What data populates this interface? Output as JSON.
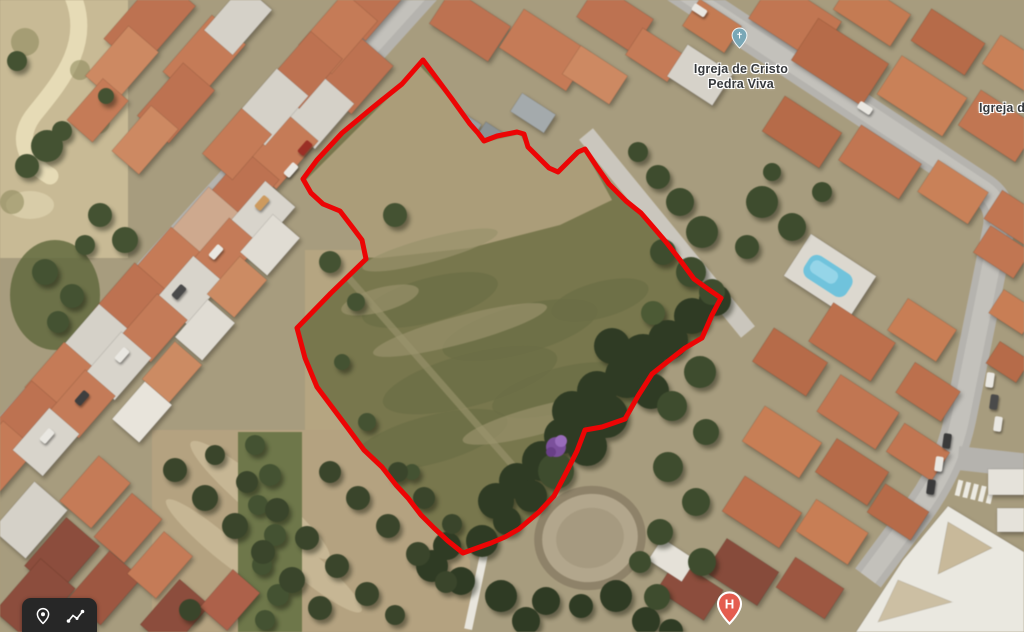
{
  "map": {
    "poi_labels": {
      "church": {
        "line1": "Igreja de Cristo",
        "line2": "Pedra Viva"
      },
      "church_partial": "Igreja d"
    },
    "markers": {
      "church": {
        "glyph": "✝"
      },
      "hospital": {
        "letter": "H"
      }
    }
  },
  "toolbar": {
    "buttons": [
      {
        "id": "add-placemark",
        "icon": "location-pin-icon"
      },
      {
        "id": "add-path",
        "icon": "polyline-icon"
      }
    ]
  },
  "overlay": {
    "parcel_outline_points": "423,60 452,99 470,124 478,133 484,141 497,136 517,132 524,134 528,147 539,158 549,168 558,172 568,162 578,152 585,149 597,167 609,184 626,201 641,213 654,228 666,242 680,260 694,279 708,289 721,298 712,315 702,338 685,348 667,362 652,374 638,396 625,419 602,427 585,430 577,451 567,471 554,496 539,512 519,529 505,537 491,543 477,548 463,553 448,541 434,528 421,515 408,498 396,485 382,467 364,450 347,427 332,407 317,387 305,358 297,328 331,293 366,259 362,240 353,228 340,211 323,204 311,193 303,179 317,160 342,133 372,108 402,84"
  },
  "colors": {
    "boundary-red": "#ec0505",
    "church-pin": "#79a7b6",
    "hospital-pin": "#e45c4f",
    "toolbar-bg": "#272727",
    "pool-blue": "#6cc4de"
  }
}
